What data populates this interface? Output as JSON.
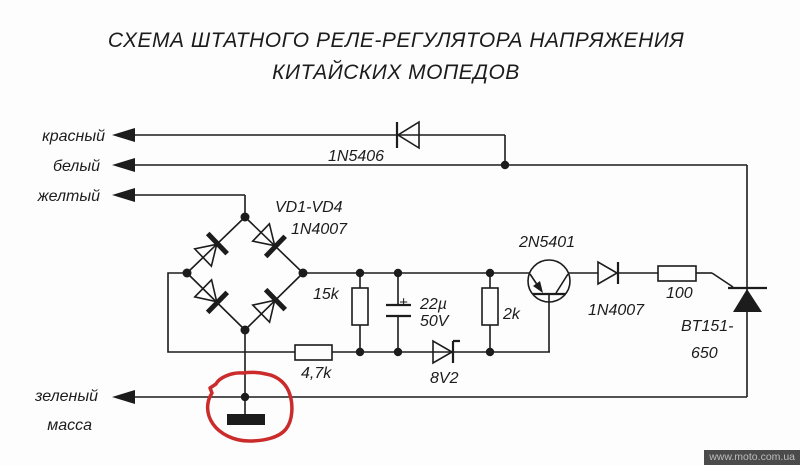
{
  "title": {
    "line1": "СХЕМА ШТАТНОГО РЕЛЕ-РЕГУЛЯТОРА НАПРЯЖЕНИЯ",
    "line2": "КИТАЙСКИХ МОПЕДОВ"
  },
  "wire_labels": {
    "red": "красный",
    "white": "белый",
    "yellow": "желтый",
    "green": "зеленый",
    "ground": "масса"
  },
  "components": {
    "rectifier_diode": "1N5406",
    "bridge_designators": "VD1-VD4",
    "bridge_part_number": "1N4007",
    "resistor_15k": "15k",
    "capacitor_plus": "+",
    "capacitor_value": "22µ",
    "capacitor_voltage": "50V",
    "resistor_2k": "2k",
    "resistor_4k7": "4,7k",
    "zener_voltage": "8V2",
    "transistor_part": "2N5401",
    "output_diode": "1N4007",
    "gate_resistor": "100",
    "thyristor_part_line1": "BT151-",
    "thyristor_part_line2": "650"
  },
  "watermark": {
    "text": "www.moto.com.ua"
  },
  "colors": {
    "line": "#1c1c1c",
    "annotation": "#cb2b2b",
    "background": "#fdfdfd",
    "watermark_bg": "#4b4b4b",
    "watermark_text": "#bdbdbd"
  }
}
